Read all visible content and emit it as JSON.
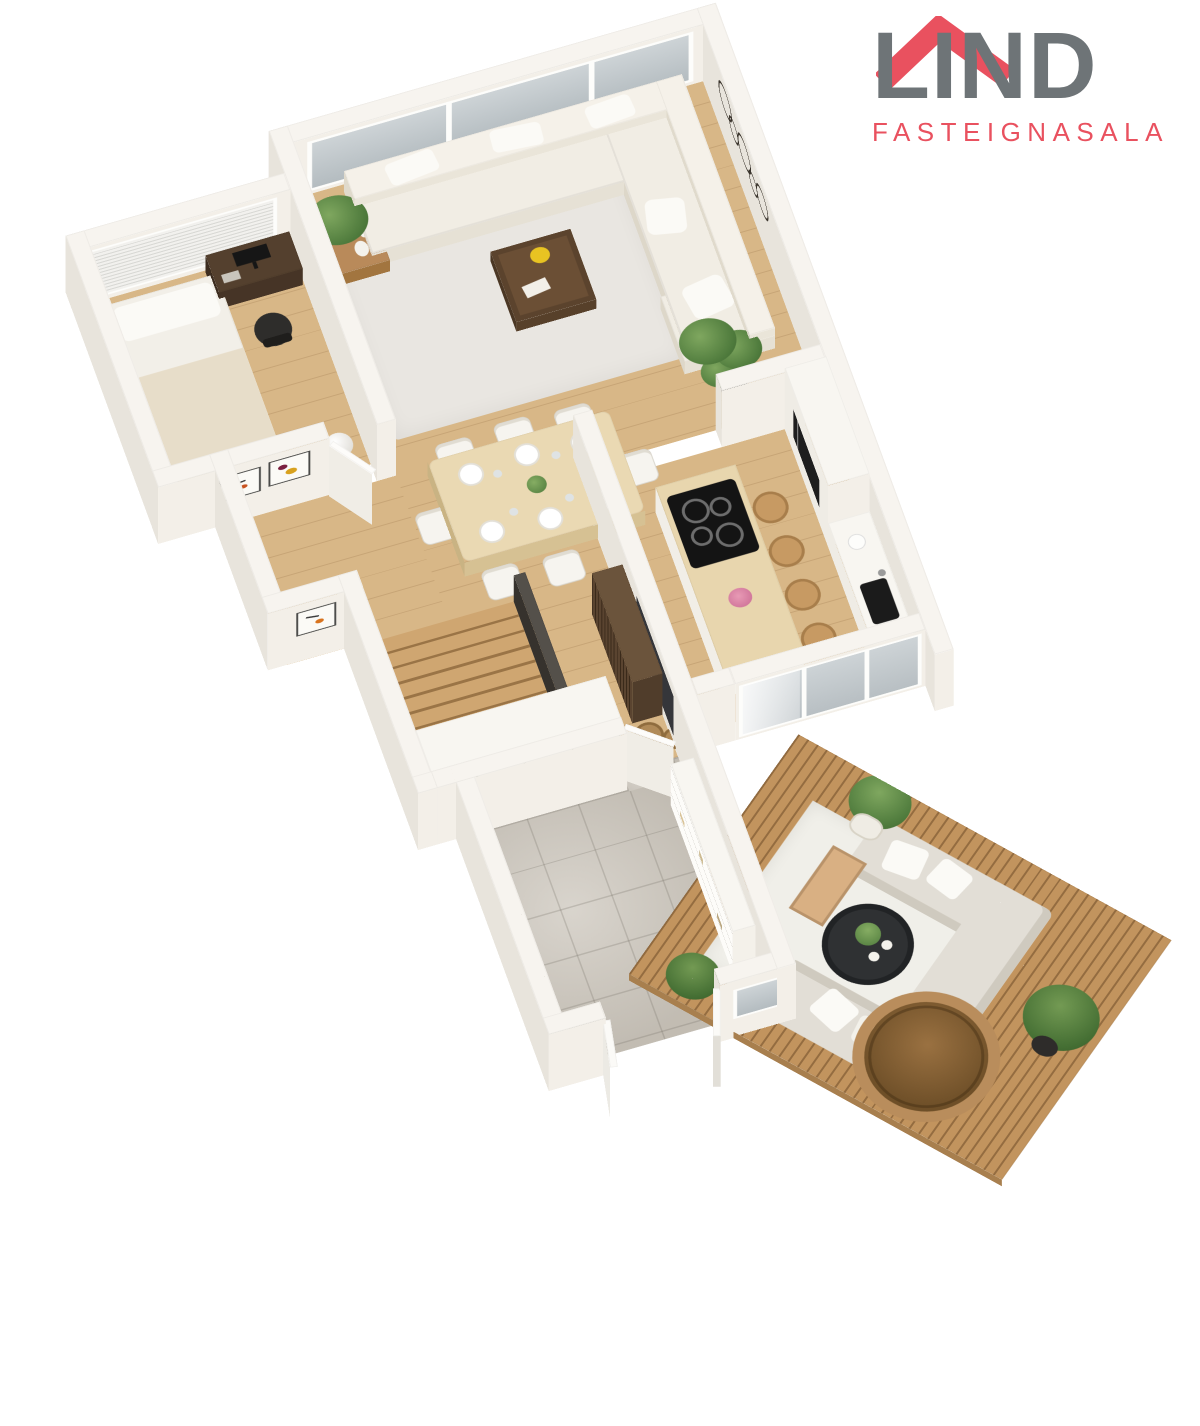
{
  "brand": {
    "name": "LIND",
    "tagline": "FASTEIGNASALA",
    "logo_icon": "house-roof-icon"
  },
  "scene": {
    "type": "isometric-3d-floor-plan"
  },
  "colors": {
    "brand_red": "#e9515f",
    "brand_gray": "#6e7477",
    "wall_top": "#f7f4ef",
    "wall_south": "#f3efe8",
    "wall_west": "#e8e4dc",
    "floor_wood": "#d8b787",
    "floor_tile": "#ccc6bc",
    "carpet": "#e9e6e1",
    "deck_wood": "#c2945e",
    "sofa_cream": "#f1ede4",
    "outdoor_sofa": "#e2ded6",
    "dark_wood": "#5c4632",
    "black_accent": "#2e2d2b",
    "plant_green": "#5f8a48",
    "glass": "#c3cacd"
  }
}
